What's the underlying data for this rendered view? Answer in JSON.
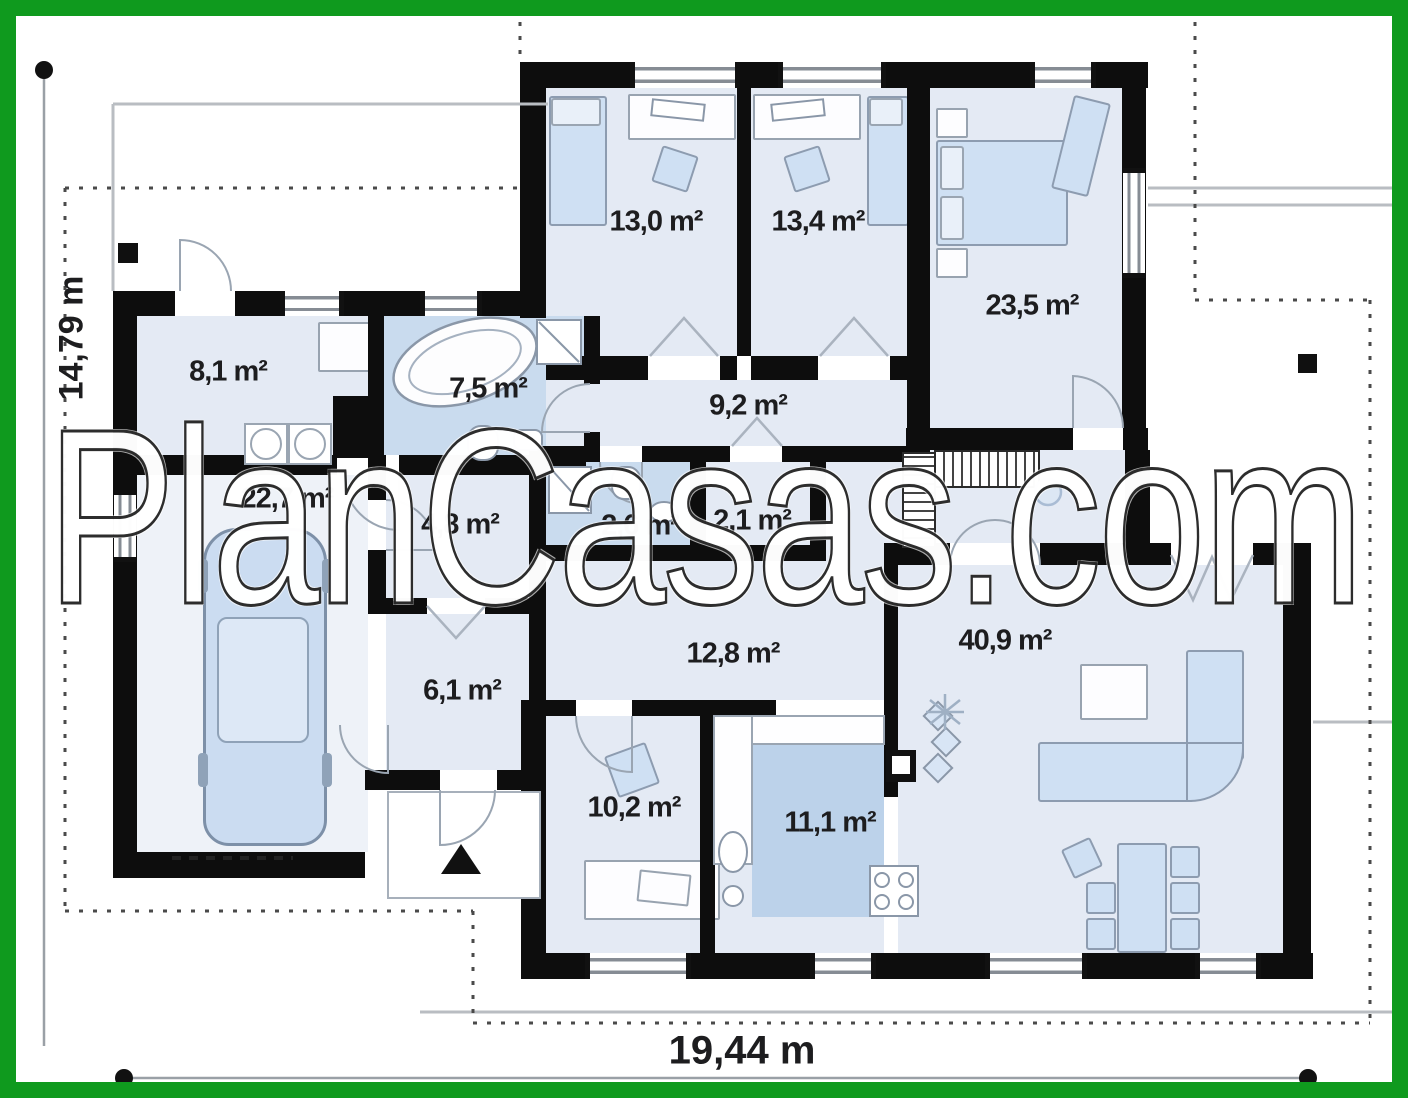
{
  "watermark": "PlanCasas.com",
  "dimensions": {
    "width": "19,44 m",
    "height": "14,79 m"
  },
  "rooms": [
    {
      "id": "bedroom-1",
      "area": "13,0 m²"
    },
    {
      "id": "bedroom-2",
      "area": "13,4 m²"
    },
    {
      "id": "master-bedroom",
      "area": "23,5 m²"
    },
    {
      "id": "entry-hall",
      "area": "8,1 m²"
    },
    {
      "id": "bathroom",
      "area": "7,5 m²"
    },
    {
      "id": "corridor",
      "area": "9,2 m²"
    },
    {
      "id": "garage",
      "area": "22,7 m²"
    },
    {
      "id": "hall-small",
      "area": "4,8 m²"
    },
    {
      "id": "wc",
      "area": "2,6 m²"
    },
    {
      "id": "closet",
      "area": "2,1 m²"
    },
    {
      "id": "hall",
      "area": "12,8 m²"
    },
    {
      "id": "living-room",
      "area": "40,9 m²"
    },
    {
      "id": "vestibule",
      "area": "6,1 m²"
    },
    {
      "id": "office",
      "area": "10,2 m²"
    },
    {
      "id": "kitchen",
      "area": "11,1 m²"
    }
  ],
  "colors": {
    "frame": "#0f9a1e",
    "wall": "#0d0d0d",
    "floor": "#e4eaf4",
    "floor_wet": "#c9dbee",
    "floor_kitchen": "#bcd2ea",
    "furn": "#cfe0f3",
    "line": "#b9bdc2"
  }
}
